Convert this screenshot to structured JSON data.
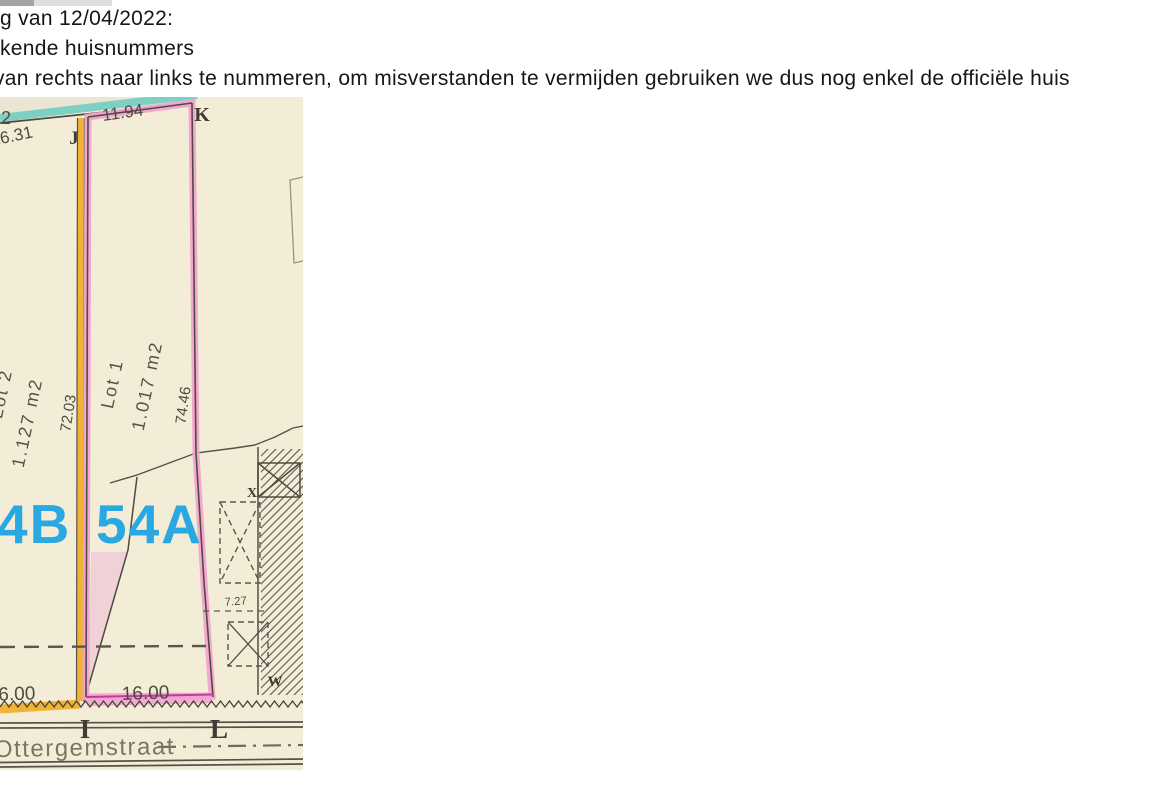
{
  "document": {
    "lines": [
      "g van 12/04/2022:",
      "kende huisnummers",
      "van rechts naar links te nummeren, om misverstanden te vermijden gebruiken we dus nog enkel de officiële huis"
    ]
  },
  "map": {
    "street": {
      "name": "Ottergemstraat"
    },
    "points": {
      "J": "J",
      "K": "K",
      "I": "I",
      "L": "L",
      "X": "X",
      "W": "W"
    },
    "lots": {
      "lot2": {
        "house_number": "4B",
        "name": "Lot 2",
        "area": "1.127 m2",
        "side_length": "72.03",
        "frontage": "16.00"
      },
      "lot1": {
        "house_number": "54A",
        "name": "Lot 1",
        "area": "1.017 m2",
        "side_length": "74.46",
        "frontage": "16.00",
        "top_width": "11.94"
      }
    },
    "measurements": {
      "top_left_length": "16.31",
      "top_left_partial": "2",
      "building_offset": "7.27"
    },
    "colors": {
      "house_number_blue": "#2aa8e1",
      "lot1_pink": "#f2a4d0",
      "lot1_magenta": "#c23a9e",
      "lot2_orange": "#f1b335",
      "boundary_teal": "#7ed0c4",
      "paper": "#f3edd8",
      "ink": "#55504a"
    }
  }
}
